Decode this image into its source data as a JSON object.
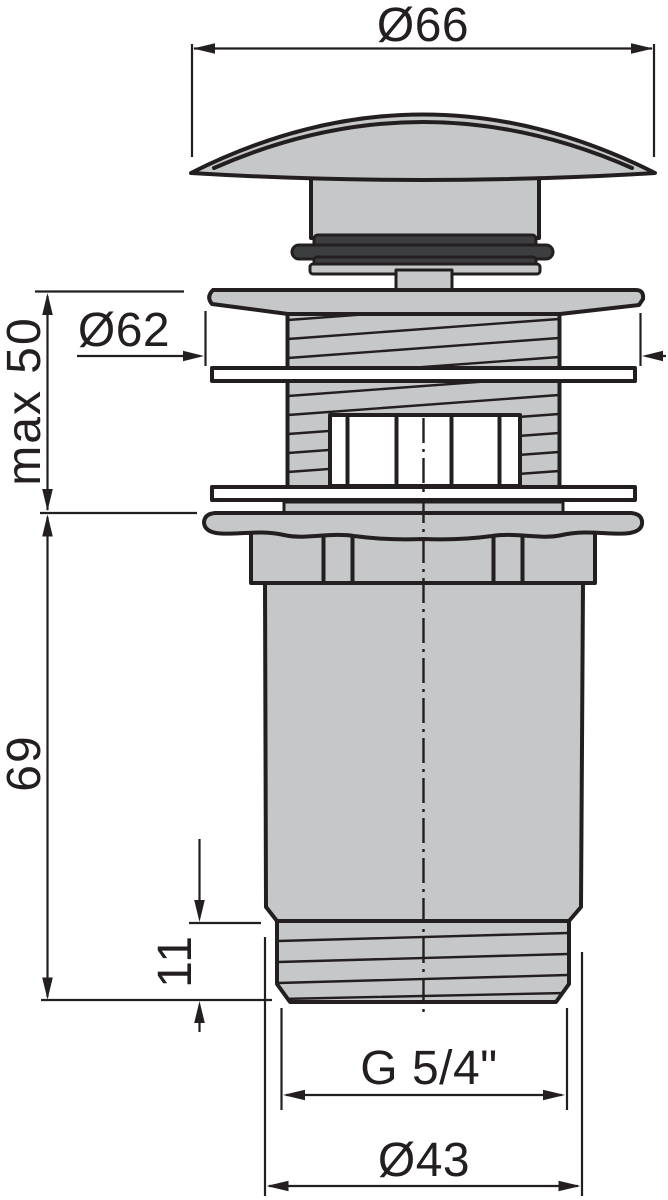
{
  "diagram": {
    "view": "side elevation technical drawing of a drain valve with dimension callouts",
    "background": "#ffffff",
    "colors": {
      "outline": "#231f20",
      "metal_fill": "#c6c7c9",
      "seal_fill": "#3d3e40"
    },
    "dimensions": {
      "cap_diameter": {
        "label": "Ø66",
        "value": 66
      },
      "flange_diameter": {
        "label": "Ø62",
        "value": 62
      },
      "clamping_range": {
        "label": "max 50",
        "value": 50
      },
      "body_length": {
        "label": "69",
        "value": 69
      },
      "thread_length": {
        "label": "11",
        "value": 11
      },
      "thread_size": {
        "label": "G 5/4\""
      },
      "outlet_diameter": {
        "label": "Ø43",
        "value": 43
      }
    }
  }
}
